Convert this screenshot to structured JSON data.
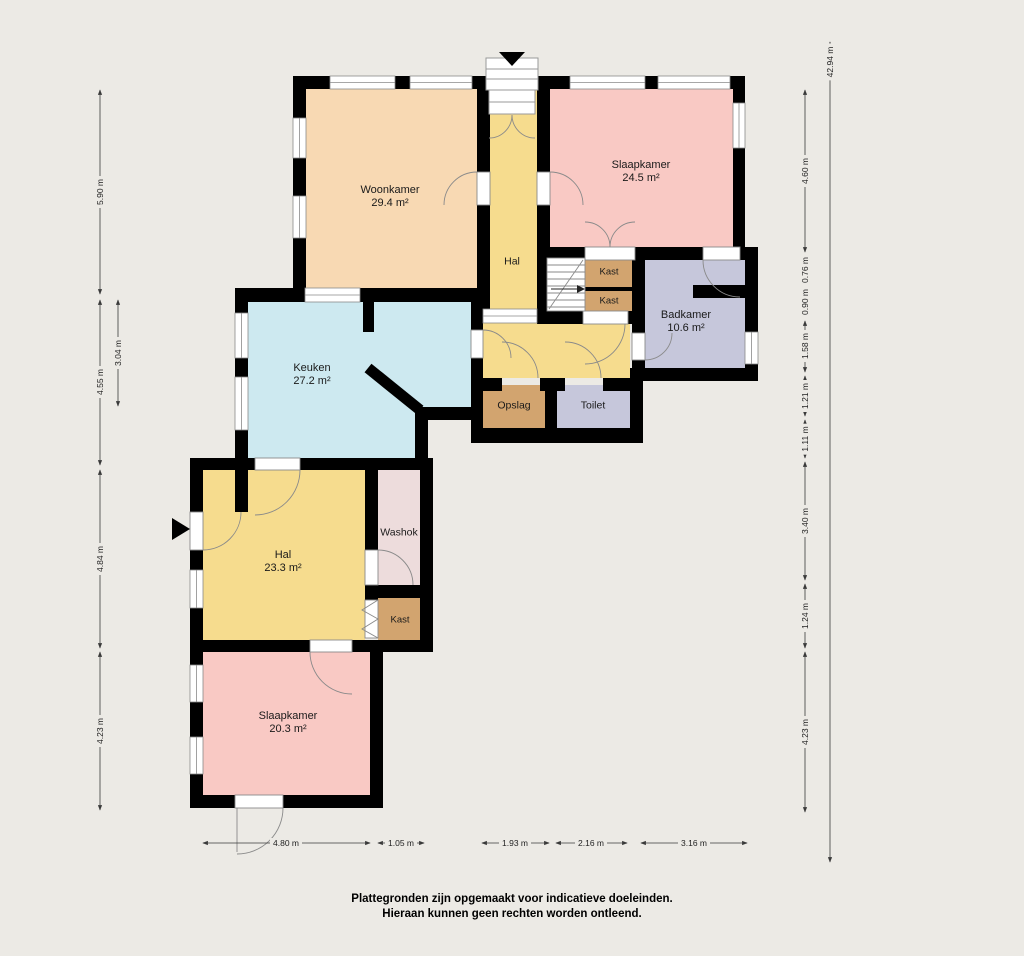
{
  "rooms": {
    "woonkamer": {
      "name": "Woonkamer",
      "area": "29.4 m²"
    },
    "slaapkamer1": {
      "name": "Slaapkamer",
      "area": "24.5 m²"
    },
    "hal_boven": {
      "name": "Hal"
    },
    "kast_a": {
      "name": "Kast"
    },
    "kast_b": {
      "name": "Kast"
    },
    "badkamer": {
      "name": "Badkamer",
      "area": "10.6 m²"
    },
    "keuken": {
      "name": "Keuken",
      "area": "27.2 m²"
    },
    "opslag": {
      "name": "Opslag"
    },
    "toilet": {
      "name": "Toilet"
    },
    "hal_beneden": {
      "name": "Hal",
      "area": "23.3 m²"
    },
    "washok": {
      "name": "Washok"
    },
    "kast_c": {
      "name": "Kast"
    },
    "slaapkamer2": {
      "name": "Slaapkamer",
      "area": "20.3 m²"
    }
  },
  "dimensions": {
    "left": [
      "5.90 m",
      "4.55 m",
      "3.04 m",
      "4.84 m",
      "4.23 m"
    ],
    "right_total": "42.94 m",
    "right": [
      "4.60 m",
      "0.76 m",
      "0.90 m",
      "1.58 m",
      "1.21 m",
      "1.11 m",
      "3.40 m",
      "1.24 m",
      "4.23 m"
    ],
    "bottom": [
      "4.80 m",
      "1.05 m",
      "1.93 m",
      "2.16 m",
      "3.16 m"
    ]
  },
  "disclaimer": {
    "line1": "Plattegronden zijn opgemaakt voor indicatieve doeleinden.",
    "line2": "Hieraan kunnen geen rechten worden ontleend."
  },
  "colors": {
    "background": "#ECEAE5",
    "wall": "#000000",
    "woonkamer": "#F8D9B3",
    "slaapkamer": "#F9C9C4",
    "hal": "#F6DC8E",
    "keuken": "#CDE9F0",
    "badkamer": "#C6C7DB",
    "kast": "#D2A46F",
    "washok": "#EDDCDC",
    "window": "#FFFFFF",
    "dim_line": "#3A3A3A",
    "text": "#1A1A1A"
  }
}
